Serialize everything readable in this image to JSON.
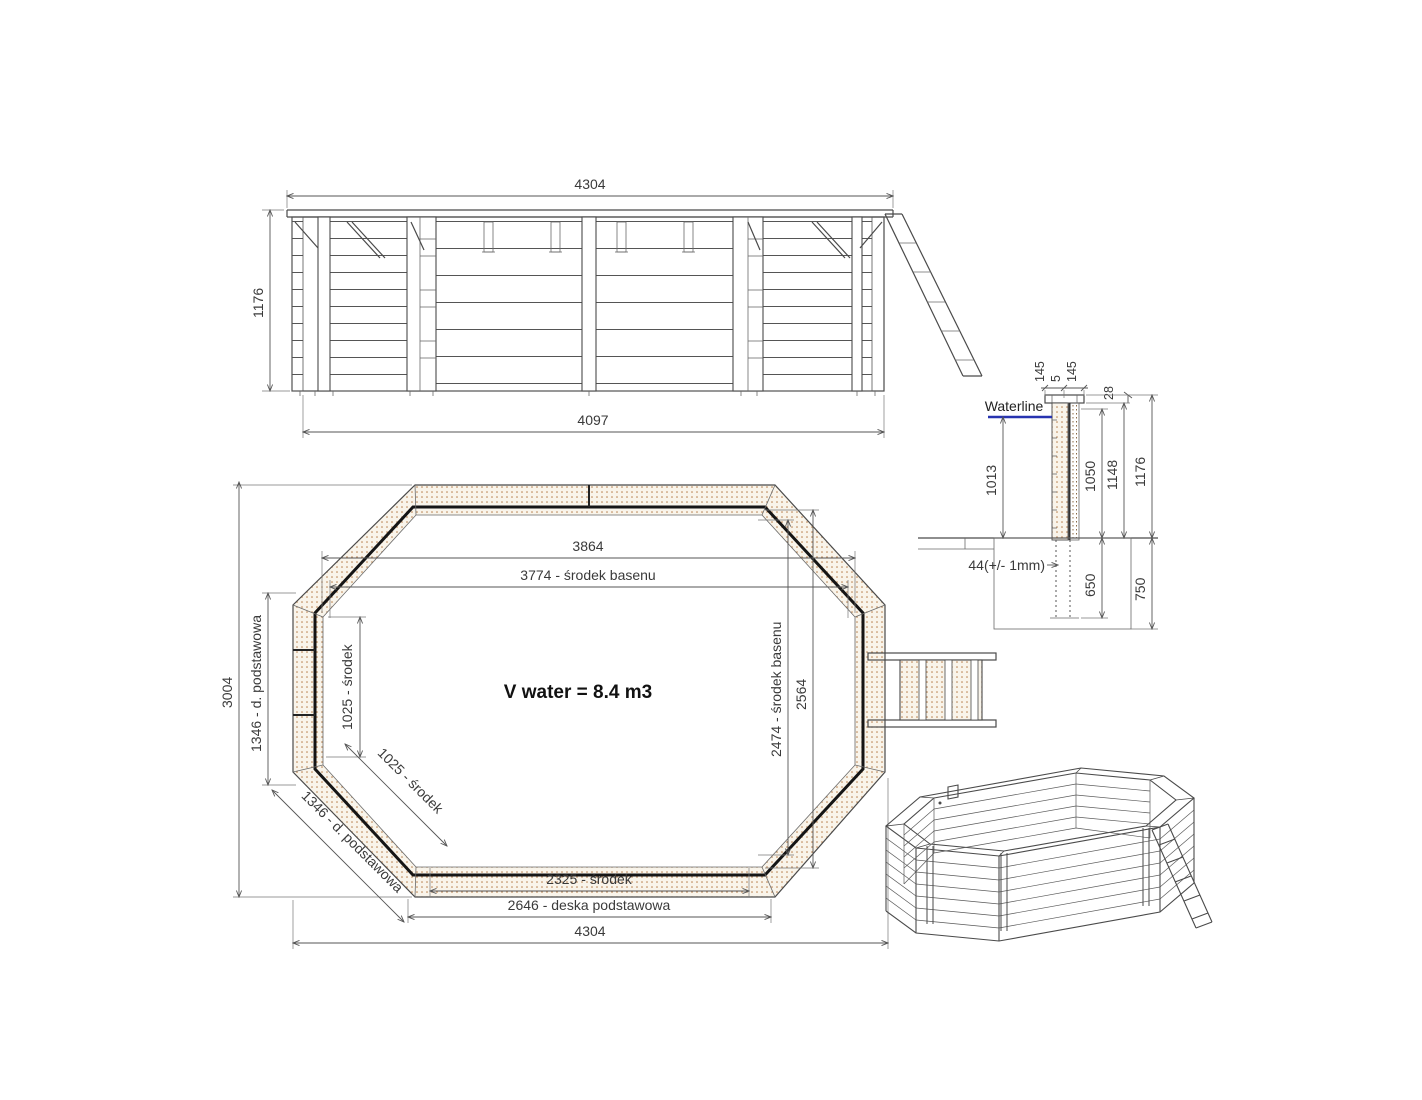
{
  "drawing": {
    "elevation": {
      "dim_top_width": "4304",
      "dim_height": "1176",
      "dim_bottom_width": "4097"
    },
    "plan": {
      "dim_inner_width": "3864",
      "dim_center_width": "3774 - środek basenu",
      "dim_side_vert": "1025 - środek",
      "dim_base_vert": "1346 - d. podstawowa",
      "dim_total_height": "3004",
      "dim_center_height": "2474 - środek basenu",
      "dim_inner_height": "2564",
      "dim_side_diag": "1025 - środek",
      "dim_base_diag": "1346 - d. podstawowa",
      "dim_bottom_center": "2325 - środek",
      "dim_base_board": "2646 - deska podstawowa",
      "dim_total_width": "4304",
      "volume_label": "V water = 8.4 m3"
    },
    "section": {
      "dim_cap_left": "145",
      "dim_cap_gap": "5",
      "dim_cap_right": "145",
      "dim_cap_thickness": "28",
      "waterline_label": "Waterline",
      "dim_water_depth": "1013",
      "dim_wall_inner": "1050",
      "dim_wall_outer": "1148",
      "dim_total_height": "1176",
      "dim_tolerance": "44(+/- 1mm)",
      "dim_below_ground": "650",
      "dim_foundation_depth": "750"
    },
    "colors": {
      "hatch_dot": "#b0703a",
      "hatch_bg": "#f9f4ea",
      "waterline": "#2733b0",
      "line": "#4a4a4a"
    }
  }
}
